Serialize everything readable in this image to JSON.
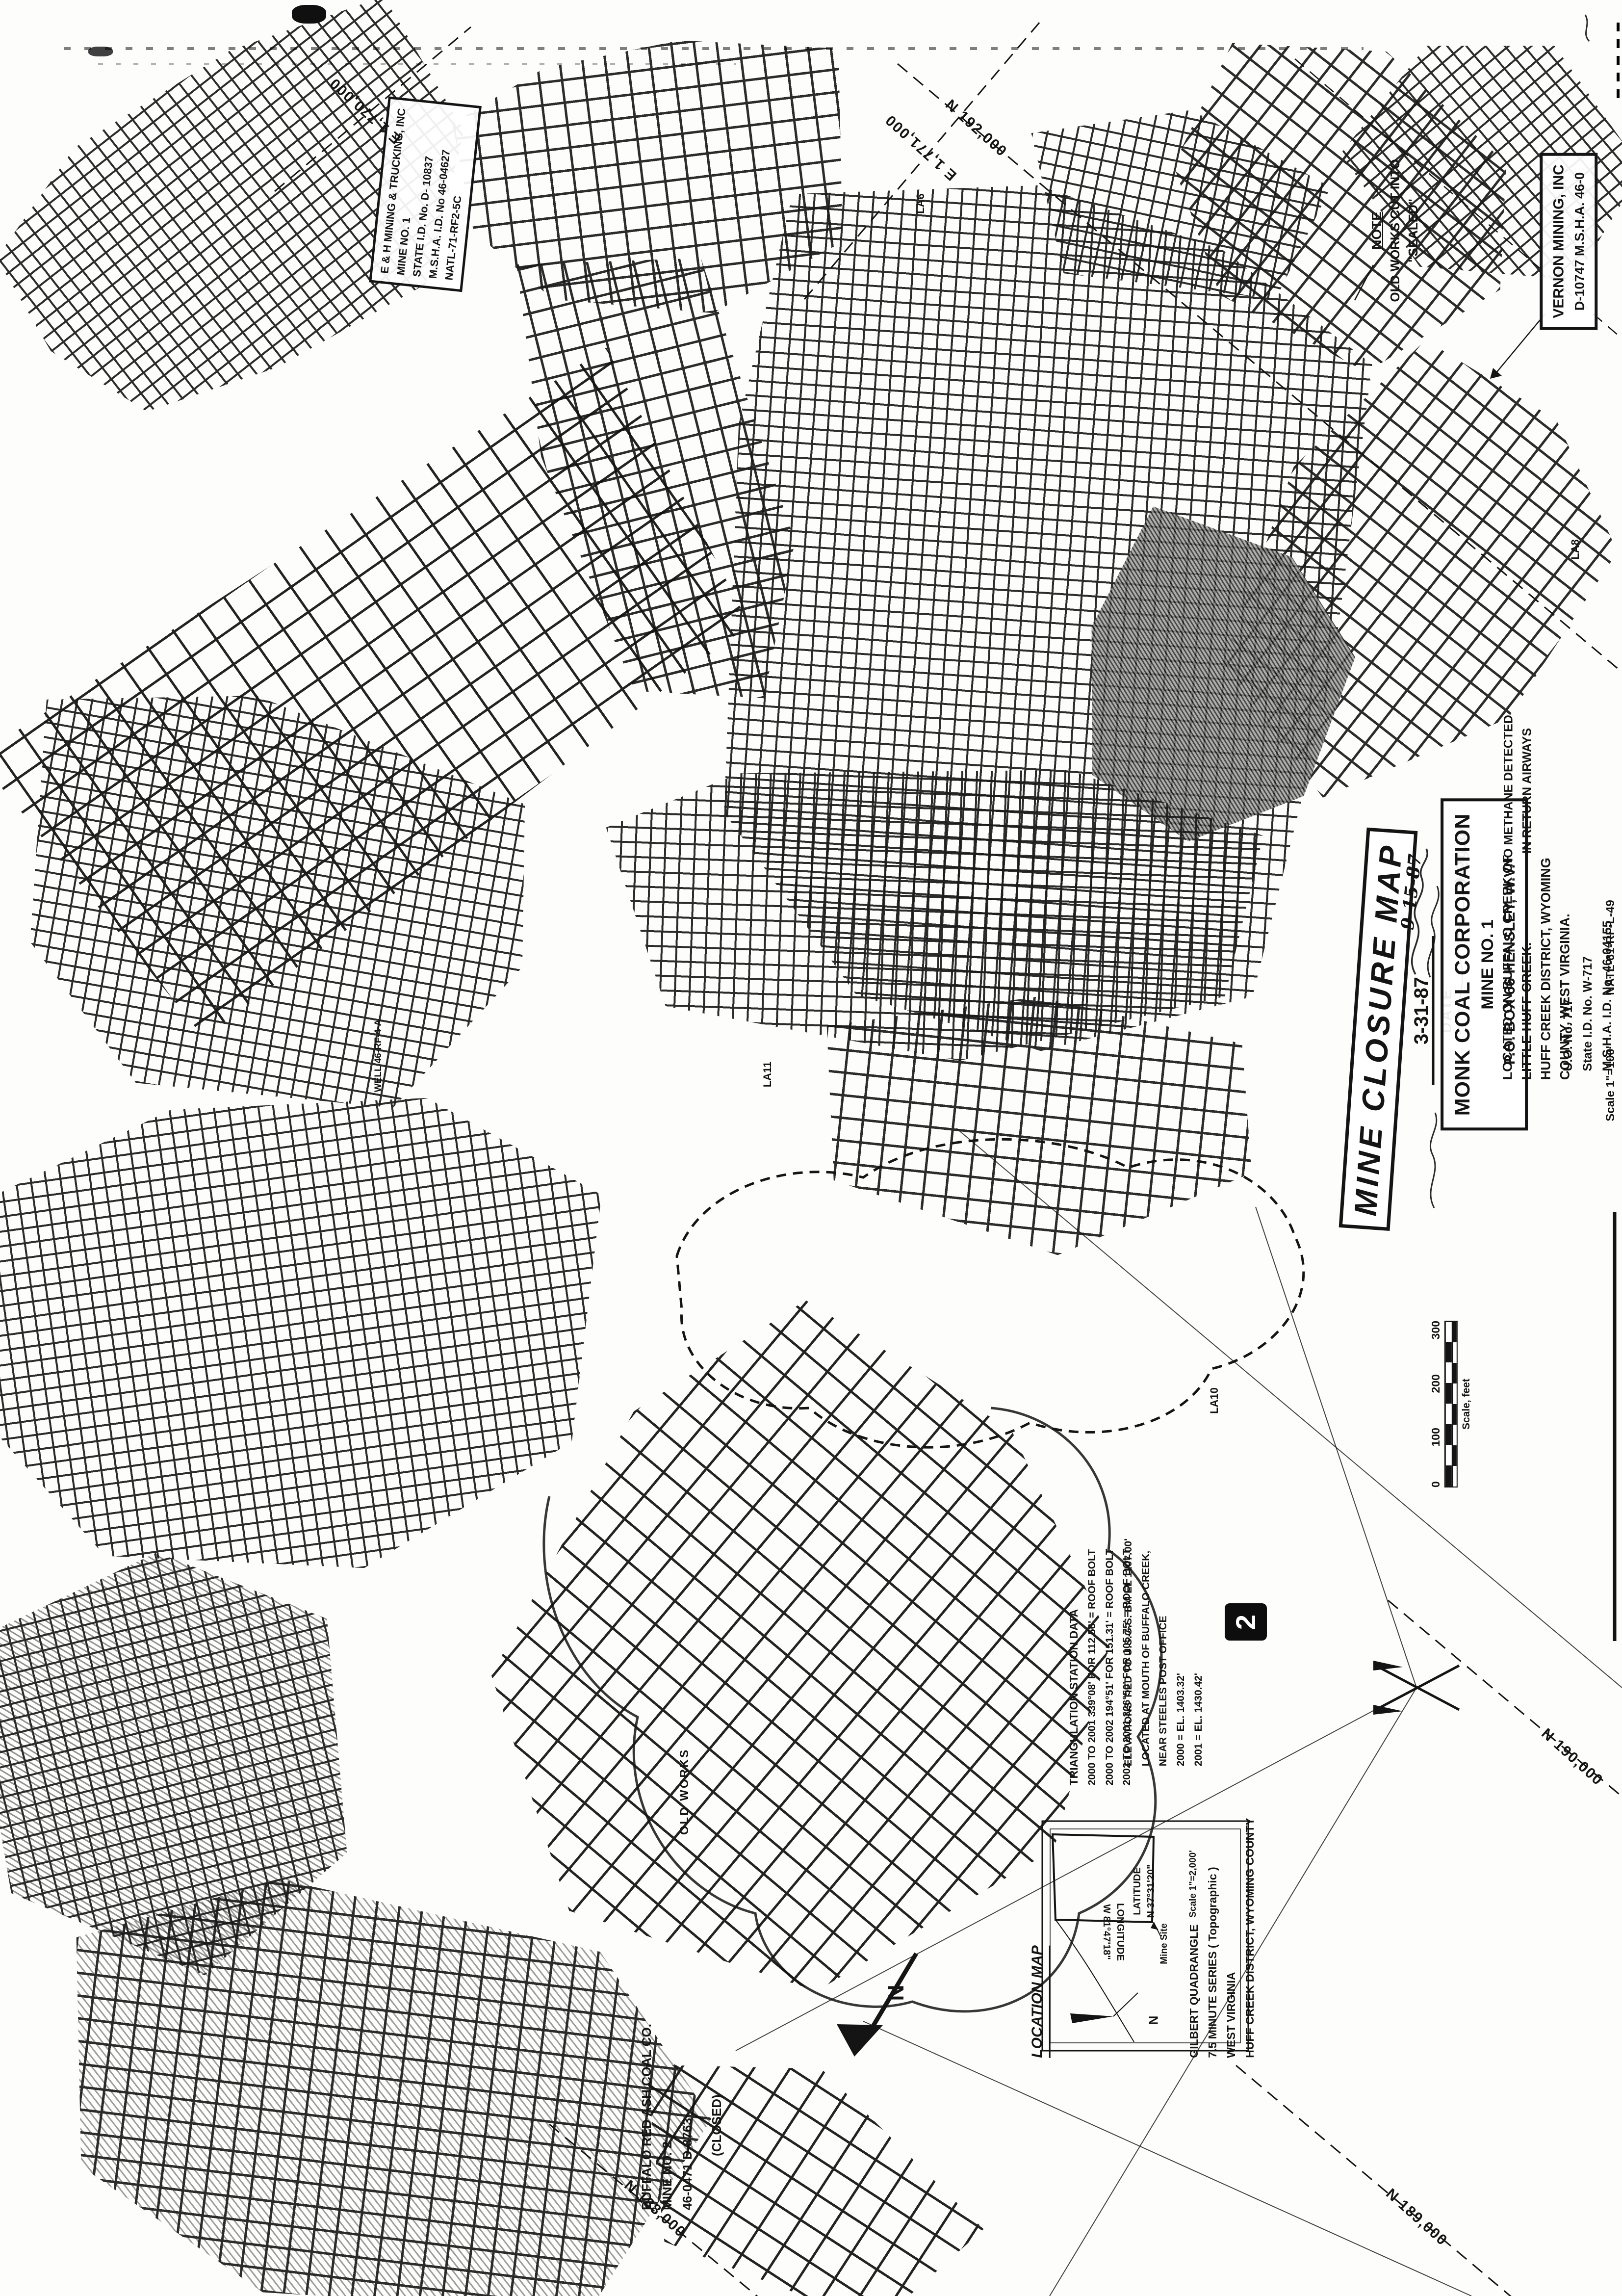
{
  "title_block": {
    "title": "MINE CLOSURE MAP",
    "date_value": "3-31-87",
    "date_label": "DATE",
    "handwritten_date1": "9-15-87",
    "handwritten_date2": "9-29-87"
  },
  "company_box": {
    "lines": [
      "MONK COAL CORPORATION",
      "MINE NO. 1",
      "P.O. BOX 66   HENSLEY, W.V."
    ]
  },
  "location_text": {
    "lines": [
      "LOCATED ON BUFFALO CREEK OF",
      "LITTLE HUFF CREEK.",
      "HUFF CREEK DISTRICT, WYOMING",
      "COUNTY, WEST VIRGINIA."
    ]
  },
  "id_block": {
    "lines": [
      "U.O. No. 717",
      "State I.D. No.  W-717",
      "M.S.H.A. I.D. No. 46-04155"
    ]
  },
  "scale_note": "Scale 1\"=100'",
  "drawing_no": "NATL-61-RF-L-49",
  "scale_bar": {
    "ticks": [
      "0",
      "100",
      "200",
      "300"
    ],
    "caption": "Scale, feet"
  },
  "eh_box": {
    "lines": [
      "E & H MINING & TRUCKING, INC",
      "MINE NO. 1",
      "STATE I.D. No. D- 10837",
      "M.S.H.A. I.D. No 46-04627",
      "NATL-71-RF2-5C"
    ]
  },
  "vernon_box": {
    "lines": [
      "VERNON MINING, INC",
      "D-10747    M.S.H.A. 46-0"
    ]
  },
  "note_box": {
    "lines": [
      "NOTE",
      "OLD WORKS CUT INTO",
      "\"SEALED\""
    ]
  },
  "methane_note": {
    "lines": [
      "NO METHANE DETECTED",
      "IN RETURN AIRWAYS"
    ]
  },
  "triangulation": {
    "title": "TRIANGULATION STATION DATA",
    "rows": [
      "2000 TO 2001    339°08' FOR 112.56'  =  ROOF BOLT",
      "2000 TO 2002    194°51' FOR 151.31'  =  ROOF BOLT",
      "2002 TO 2001    326°50' FOR 105.75'  =  ROOF BOLT"
    ]
  },
  "elevations": {
    "lines": [
      "ELEVATIONS TIED TO U.S.G.S. BM EL 1107.00'",
      "LOCATED AT MOUTH OF BUFFALO CREEK,",
      "NEAR STEELES POST OFFICE",
      "2000 = EL. 1403.32'",
      "2001 = EL. 1430.42'"
    ]
  },
  "buffalo_label": {
    "lines": [
      "BUFFALO RED ASH COAL CO.",
      "MINE NO. 2",
      "46-0471    D-8763",
      "(CLOSED)"
    ]
  },
  "old_works_label": "OLD WORKS",
  "well_label": "WELL 46-RF-4-A",
  "sheet_number": "2",
  "north_arrow_letter": "N",
  "location_map": {
    "title": "LOCATION MAP",
    "latitude": [
      "LATITUDE",
      "N 37°31'20\""
    ],
    "longitude": [
      "LONGITUDE",
      "W 81°47'18\""
    ],
    "mine_site": "Mine Site",
    "scale": "Scale 1\"=2,000'",
    "quad": [
      "GILBERT QUADRANGLE",
      "7.5 MINUTE SERIES ( Topographic )",
      "WEST VIRGINIA",
      "HUFF CREEK DISTRICT, WYOMING COUNTY"
    ],
    "north": "N"
  },
  "grid_labels": {
    "n192": "N 192,000",
    "n190": "N 190,000",
    "n189": "N 189,000",
    "n188": "N 188,000",
    "e1770": "E 1,770,000",
    "e1771": "E 1,771,000"
  },
  "survey_labels": {
    "la6": "LA6",
    "la8": "LA8",
    "la10": "LA10",
    "la11": "LA11"
  },
  "ink_color": "#141414"
}
